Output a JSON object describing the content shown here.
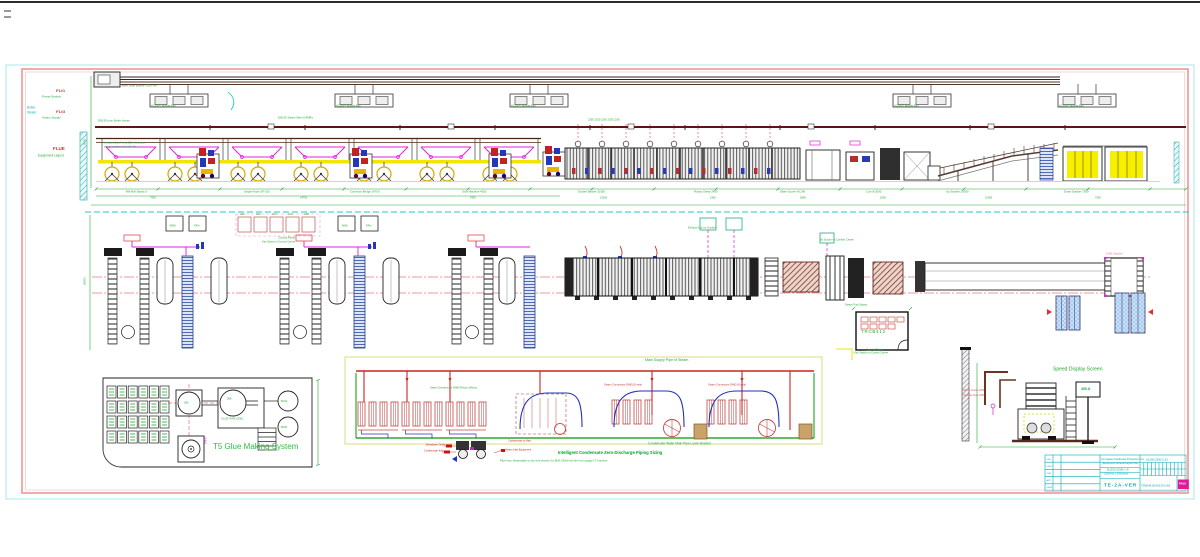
{
  "sheet": {
    "background": "#ffffff",
    "frame_outer_color": "#b5ecec",
    "frame_inner_color": "#ef9696",
    "top_rule_color": "#2a2a2a",
    "cad_green": "#22a833",
    "cad_red": "#cc2222",
    "cad_magenta": "#e020e0",
    "cad_cyan": "#00b7c3",
    "cad_yellow": "#f5e400",
    "titleblock_teal": "#00a7b3"
  },
  "defaults": {
    "label_color": "#22a833",
    "label_size": 3.2
  },
  "labels": [
    {
      "n": "margin-code-power",
      "t": "F1#1",
      "x": 56,
      "y": 91,
      "c": "#cc3333",
      "s": 4,
      "w": 700
    },
    {
      "n": "margin-name-power",
      "t": "Power Busbar",
      "x": 42,
      "y": 96.5,
      "s": 3
    },
    {
      "n": "margin-cyan-line1",
      "t": "Boiler",
      "x": 27,
      "y": 108,
      "c": "#00b7c3",
      "s": 3.2
    },
    {
      "n": "margin-cyan-line2",
      "t": "Steam",
      "x": 27,
      "y": 112.5,
      "c": "#00b7c3",
      "s": 3.2
    },
    {
      "n": "margin-code-steam",
      "t": "F1#3",
      "x": 56,
      "y": 112,
      "c": "#cc3333",
      "s": 4,
      "w": 700
    },
    {
      "n": "margin-name-steam",
      "t": "Steam Supply",
      "x": 42,
      "y": 117.5,
      "s": 3
    },
    {
      "n": "margin-code-flue",
      "t": "FLUE",
      "x": 53,
      "y": 149,
      "c": "#cc3333",
      "s": 4.5,
      "w": 700
    },
    {
      "n": "margin-name-flue",
      "t": "Equipment Layout",
      "x": 38,
      "y": 156,
      "s": 3.2
    },
    {
      "t": "Power Slide Busbar 630A x4P",
      "x": 120,
      "y": 86,
      "s": 2.8
    },
    {
      "t": "AC380V Busbar Box",
      "x": 151,
      "y": 107,
      "s": 2.7
    },
    {
      "t": "AC380V Busbar Box",
      "x": 336,
      "y": 107,
      "s": 2.7
    },
    {
      "t": "AC380V Busbar Box",
      "x": 511,
      "y": 107,
      "s": 2.7
    },
    {
      "t": "AC380V Busbar Box",
      "x": 894,
      "y": 107,
      "s": 2.7
    },
    {
      "t": "AC380V Busbar Box",
      "x": 1059,
      "y": 107,
      "s": 2.7
    },
    {
      "t": "DN150 from Boiler House",
      "x": 98,
      "y": 121,
      "s": 2.8
    },
    {
      "t": "DN125 Steam Main 0.8MPa",
      "x": 278,
      "y": 118,
      "s": 2.8
    },
    {
      "t": "Insulated pipe, keep 2.2m clearance",
      "x": 104,
      "y": 144,
      "s": 2.6
    },
    {
      "t": "along machine hall wall side",
      "x": 104,
      "y": 148,
      "s": 2.6
    },
    {
      "t": "2250    2250    2250    2250    2250",
      "x": 588,
      "y": 121,
      "s": 2.6
    },
    {
      "t": "Mill Roll Stand x7",
      "x": 126,
      "y": 192,
      "s": 2.8
    },
    {
      "t": "Single Facer SF-320",
      "x": 244,
      "y": 192,
      "s": 2.8
    },
    {
      "t": "Conveyor Bridge 14700",
      "x": 350,
      "y": 192,
      "s": 2.8
    },
    {
      "t": "Glue Machine 4350",
      "x": 462,
      "y": 192,
      "s": 2.8
    },
    {
      "t": "Double Backer 10350",
      "x": 578,
      "y": 192,
      "s": 2.8
    },
    {
      "t": "Rotary Shear 2450",
      "x": 694,
      "y": 192,
      "s": 2.8
    },
    {
      "t": "Slitter Scorer NC-80",
      "x": 780,
      "y": 192,
      "s": 2.8
    },
    {
      "t": "Cut-off 2000",
      "x": 866,
      "y": 192,
      "s": 2.8
    },
    {
      "t": "Up Stacker 10000",
      "x": 946,
      "y": 192,
      "s": 2.8
    },
    {
      "t": "Down Stacker 7500",
      "x": 1064,
      "y": 192,
      "s": 2.8
    },
    {
      "t": "7550",
      "x": 150,
      "y": 198.5,
      "s": 2.6
    },
    {
      "t": "14700",
      "x": 300,
      "y": 198.5,
      "s": 2.6
    },
    {
      "t": "4350",
      "x": 470,
      "y": 198.5,
      "s": 2.6
    },
    {
      "t": "10350",
      "x": 600,
      "y": 198.5,
      "s": 2.6
    },
    {
      "t": "2450",
      "x": 710,
      "y": 198.5,
      "s": 2.6
    },
    {
      "t": "5800",
      "x": 800,
      "y": 198.5,
      "s": 2.6
    },
    {
      "t": "2000",
      "x": 880,
      "y": 198.5,
      "s": 2.6
    },
    {
      "t": "10000",
      "x": 985,
      "y": 198.5,
      "s": 2.6
    },
    {
      "t": "7500",
      "x": 1095,
      "y": 198.5,
      "s": 2.6
    },
    {
      "t": "M5A",
      "x": 170,
      "y": 225.5,
      "s": 2.8
    },
    {
      "t": "FAN",
      "x": 194,
      "y": 225.5,
      "s": 2.8
    },
    {
      "t": "M5A",
      "x": 342,
      "y": 225.5,
      "s": 2.8
    },
    {
      "t": "FAN",
      "x": 366,
      "y": 225.5,
      "s": 2.8
    },
    {
      "t": "AD1",
      "x": 240,
      "y": 215,
      "s": 2.4
    },
    {
      "t": "AD2",
      "x": 256,
      "y": 215,
      "s": 2.4
    },
    {
      "t": "AD3",
      "x": 272,
      "y": 215,
      "s": 2.4
    },
    {
      "t": "AD4",
      "x": 288,
      "y": 215,
      "s": 2.4
    },
    {
      "t": "AD5",
      "x": 304,
      "y": 215,
      "s": 2.4
    },
    {
      "t": "Control Panel",
      "x": 278,
      "y": 238,
      "s": 2.8
    },
    {
      "t": "Key Switch in Control Centre",
      "x": 262,
      "y": 242.5,
      "s": 2.6
    },
    {
      "t": "Exhaust Duct to Outdoor",
      "x": 688,
      "y": 229,
      "s": 2.6
    },
    {
      "t": "By Suction to Comfort Centre",
      "x": 820,
      "y": 241,
      "s": 2.6
    },
    {
      "t": "28000",
      "x": 85,
      "y": 285,
      "s": 2.8,
      "r": -90
    },
    {
      "t": "9500",
      "x": 85,
      "y": 145,
      "s": 2.8,
      "r": -90
    },
    {
      "n": "control-room-code",
      "t": "TRCB412",
      "x": 861,
      "y": 332,
      "s": 4.4,
      "ls": 0.8
    },
    {
      "t": "Control Room",
      "x": 866,
      "y": 350,
      "s": 2.8
    },
    {
      "t": "Key Switch on Control Centre",
      "x": 854,
      "y": 354,
      "s": 2.6
    },
    {
      "t": "1400 Stacker",
      "x": 1106,
      "y": 254,
      "c": "#dd7788",
      "s": 2.8
    },
    {
      "t": "Steam Trap Station",
      "x": 845,
      "y": 306,
      "s": 2.6
    },
    {
      "n": "glue-system-title",
      "t": "T5 Glue Making System",
      "x": 213,
      "y": 447,
      "c": "#33bb44",
      "s": 8
    },
    {
      "t": "JB6",
      "x": 184,
      "y": 404,
      "s": 2.6
    },
    {
      "t": "JB8",
      "x": 227,
      "y": 400,
      "s": 2.6
    },
    {
      "t": "GLUE TANK 2500L",
      "x": 221,
      "y": 420,
      "s": 2.6
    },
    {
      "t": "BCN2",
      "x": 281,
      "y": 402,
      "s": 2.4
    },
    {
      "t": "BCN1",
      "x": 281,
      "y": 428,
      "s": 2.4
    },
    {
      "t": "PM-07",
      "x": 207,
      "y": 444,
      "c": "#cc22cc",
      "s": 2.6,
      "r": -90
    },
    {
      "n": "steam-diagram-title",
      "t": "Main Supply Pipe of Steam",
      "x": 645,
      "y": 360.5,
      "s": 3.6
    },
    {
      "t": "Steam Condensate DN80 Return (Motor)",
      "x": 430,
      "y": 389,
      "s": 2.6
    },
    {
      "t": "Steam Connection DN65 (8 sets)",
      "x": 604,
      "y": 386,
      "c": "#bb3333",
      "s": 2.6
    },
    {
      "t": "Steam Connection DN65 (8 sets)",
      "x": 708,
      "y": 386,
      "c": "#bb3333",
      "s": 2.6
    },
    {
      "t": "Blowdown Outlet",
      "x": 426,
      "y": 446,
      "c": "#cc2222",
      "s": 2.6
    },
    {
      "t": "Condensate Inlet",
      "x": 424,
      "y": 452,
      "c": "#cc2222",
      "s": 2.6
    },
    {
      "t": "Steam Inlet Equipment",
      "x": 505,
      "y": 450.5,
      "c": "#cc2222",
      "s": 2.6
    },
    {
      "t": "Condensate to Main",
      "x": 508,
      "y": 441.5,
      "c": "#cc2222",
      "s": 2.6
    },
    {
      "n": "condensate-caption",
      "t": "Condensate Water Main Pipe Lower Bracket",
      "x": 648,
      "y": 444,
      "s": 3.2
    },
    {
      "n": "diagram-bold-caption",
      "t": "Intelligent Condensate Zero-Discharge Piping Sizing",
      "x": 558,
      "y": 452.5,
      "c": "#00aa22",
      "s": 4.2,
      "w": 700
    },
    {
      "n": "diagram-note",
      "t": "Pipe from Steamplant to dry-end section for BHS 250m/min line incl supply (T-) section",
      "x": 500,
      "y": 461,
      "s": 2.8
    },
    {
      "n": "speed-display-title",
      "t": "Speed Display Screen",
      "x": 1053,
      "y": 370,
      "s": 5
    },
    {
      "n": "speed-display-value",
      "t": "450.8",
      "x": 1081,
      "y": 390,
      "s": 3.6,
      "w": 700
    },
    {
      "t": "Wall to Center 1500",
      "x": 963,
      "y": 391,
      "c": "#cc5555",
      "s": 2.4
    },
    {
      "t": "Operator Area 1200",
      "x": 963,
      "y": 396,
      "c": "#cc5555",
      "s": 2.4
    },
    {
      "t": "Corrugated Cardboard Production Line",
      "x": 1101,
      "y": 459.8,
      "c": "#00a7b3",
      "s": 2.5
    },
    {
      "t": "Equipment General Layout Plan",
      "x": 1103,
      "y": 464.3,
      "c": "#00a7b3",
      "s": 2.5
    },
    {
      "n": "titleblock-model",
      "t": "BJ250-2500-1-8",
      "x": 1107,
      "y": 470,
      "c": "#00a7b3",
      "s": 3
    },
    {
      "t": "2500mm x 250m/min",
      "x": 1104,
      "y": 475,
      "c": "#00a7b3",
      "s": 2.6
    },
    {
      "n": "titleblock-code",
      "t": "TE-2A-VER",
      "x": 1104,
      "y": 485.5,
      "c": "#00a7b3",
      "s": 4.6,
      "w": 700,
      "ls": 1
    },
    {
      "t": "A1250-2300-2-10",
      "x": 1146,
      "y": 459.5,
      "c": "#00a7b3",
      "s": 2.8
    },
    {
      "t": "T5WH/LQ-00123-V18",
      "x": 1141,
      "y": 486,
      "c": "#00a7b3",
      "s": 3
    },
    {
      "t": "DES",
      "x": 1046.5,
      "y": 459.5,
      "c": "#00a7b3",
      "s": 2.2
    },
    {
      "t": "DRW",
      "x": 1046.5,
      "y": 466.8,
      "c": "#00a7b3",
      "s": 2.2
    },
    {
      "t": "CHK",
      "x": 1046.5,
      "y": 474,
      "c": "#00a7b3",
      "s": 2.2
    },
    {
      "t": "APP",
      "x": 1046.5,
      "y": 481.2,
      "c": "#00a7b3",
      "s": 2.2
    },
    {
      "t": "DATE",
      "x": 1046.5,
      "y": 488.4,
      "c": "#00a7b3",
      "s": 2.2
    },
    {
      "n": "approval-stamp-text",
      "t": "PASS",
      "x": 1179,
      "y": 484.5,
      "c": "#ffffff",
      "s": 2.6,
      "w": 700
    }
  ]
}
